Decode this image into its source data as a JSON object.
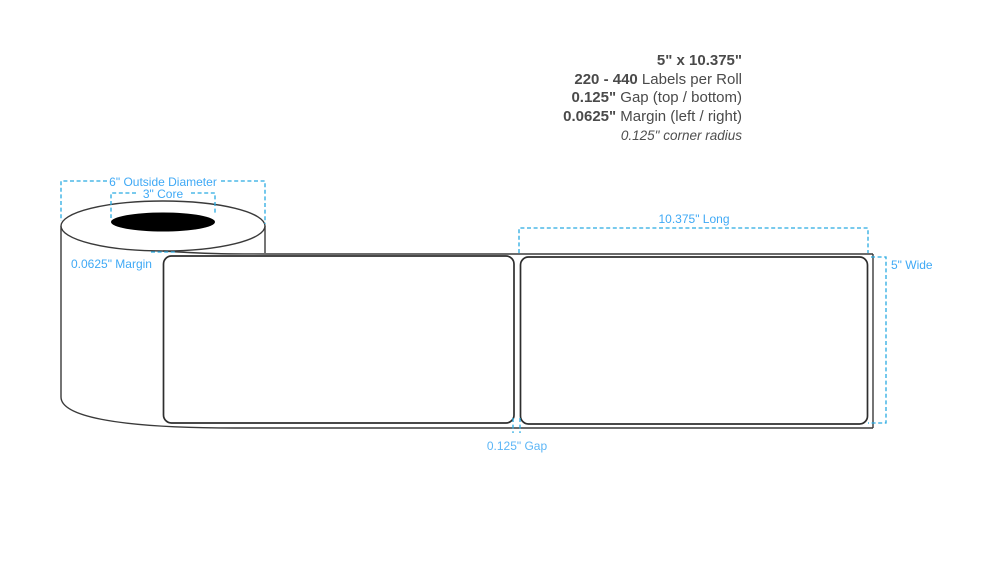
{
  "specs": {
    "size": "5\" x 10.375\"",
    "count_value": "220 - 440",
    "count_label": " Labels per Roll",
    "gap_value": "0.125\"",
    "gap_label": " Gap (top / bottom)",
    "margin_value": "0.0625\"",
    "margin_label": " Margin (left / right)",
    "corner_radius": "0.125\" corner radius"
  },
  "annotations": {
    "outside_diameter": "6\" Outside Diameter",
    "core": "3\" Core",
    "margin": "0.0625\" Margin",
    "length": "10.375\" Long",
    "width": "5\" Wide",
    "gap": "0.125\" Gap"
  },
  "colors": {
    "annotation_text": "#3FA9F5",
    "dash_line": "#29ABE2",
    "outline": "#3a3a3a",
    "core_fill": "#000000",
    "spec_text": "#4a4a4a"
  }
}
